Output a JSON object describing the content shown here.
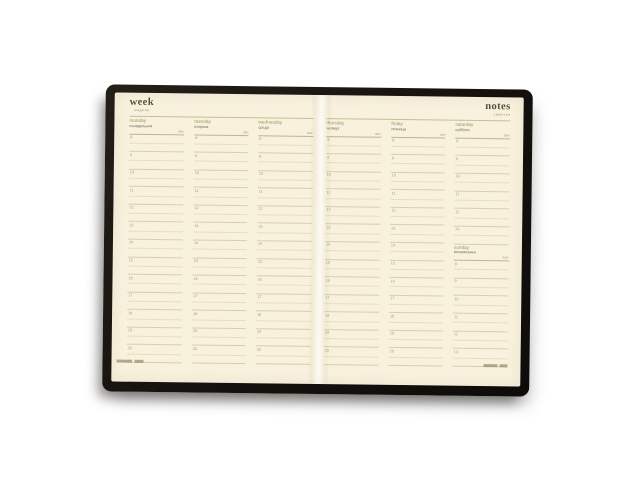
{
  "colors": {
    "cover": "#17130f",
    "paper": "#f8f1dd",
    "accent_green": "#8f9a5f",
    "ink": "#55513e",
    "rule_dark": "#c2b48b",
    "rule_light": "#e9deba"
  },
  "left_page": {
    "title": "week",
    "subtitle": "неделя"
  },
  "right_page": {
    "title": "notes",
    "subtitle": "заметки"
  },
  "date_label": "date",
  "hours_weekday": [
    "8",
    "9",
    "10",
    "11",
    "12",
    "13",
    "14",
    "15",
    "16",
    "17",
    "18",
    "19",
    "20"
  ],
  "hours_weekend": [
    "8",
    "9",
    "10",
    "11",
    "12",
    "13"
  ],
  "days": [
    {
      "en": "monday",
      "ru": "понедельник",
      "page": "left",
      "hours": "weekday"
    },
    {
      "en": "tuesday",
      "ru": "вторник",
      "page": "left",
      "hours": "weekday"
    },
    {
      "en": "wednesday",
      "ru": "среда",
      "page": "left",
      "hours": "weekday"
    },
    {
      "en": "thursday",
      "ru": "четверг",
      "page": "right",
      "hours": "weekday"
    },
    {
      "en": "friday",
      "ru": "пятница",
      "page": "right",
      "hours": "weekday"
    },
    {
      "en": "saturday",
      "ru": "суббота",
      "page": "right",
      "hours": "weekend"
    },
    {
      "en": "sunday",
      "ru": "воскресенье",
      "page": "right",
      "hours": "weekend"
    }
  ]
}
